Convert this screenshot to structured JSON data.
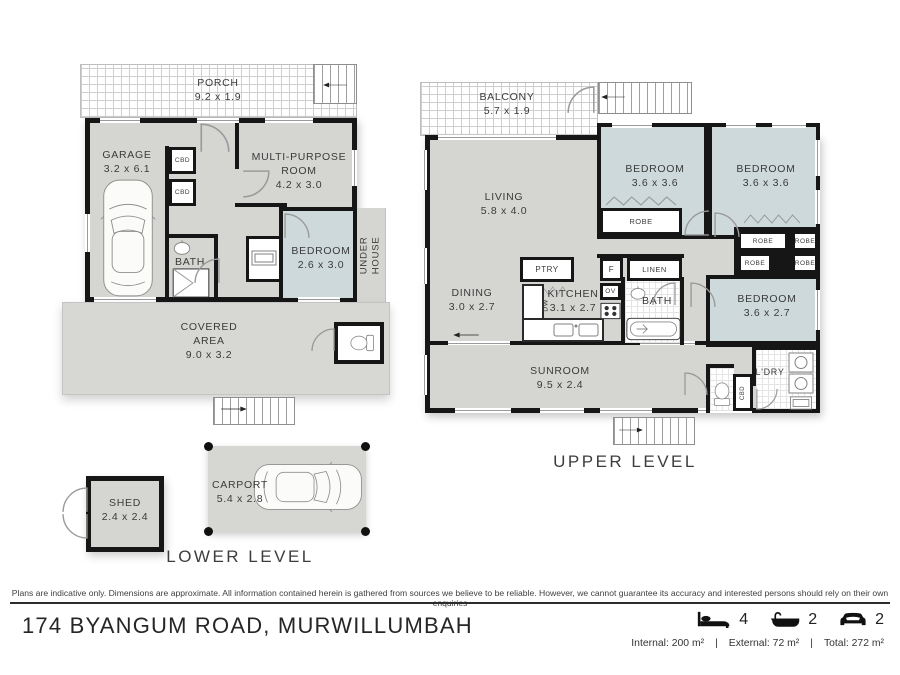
{
  "colors": {
    "wall": "#161616",
    "floor": "#d5d5d2",
    "bedroom_fill": "#cdd9da",
    "carport_fill": "#d6d6d3"
  },
  "levels": {
    "lower": "LOWER LEVEL",
    "upper": "UPPER LEVEL"
  },
  "lower": {
    "porch": {
      "name": "PORCH",
      "dim": "9.2 x 1.9"
    },
    "garage": {
      "name": "GARAGE",
      "dim": "3.2 x 6.1"
    },
    "multi_purpose": {
      "name": "MULTI-PURPOSE\nROOM",
      "dim": "4.2 x 3.0"
    },
    "bedroom": {
      "name": "BEDROOM",
      "dim": "2.6 x 3.0"
    },
    "bath": "BATH",
    "cbd": "CBD",
    "under_house": "UNDER\nHOUSE",
    "covered": {
      "name": "COVERED\nAREA",
      "dim": "9.0 x 3.2"
    },
    "shed": {
      "name": "SHED",
      "dim": "2.4 x 2.4"
    },
    "carport": {
      "name": "CARPORT",
      "dim": "5.4 x 2.8"
    }
  },
  "upper": {
    "balcony": {
      "name": "BALCONY",
      "dim": "5.7 x 1.9"
    },
    "living": {
      "name": "LIVING",
      "dim": "5.8 x 4.0"
    },
    "dining": {
      "name": "DINING",
      "dim": "3.0 x 2.7"
    },
    "kitchen": {
      "name": "KITCHEN",
      "dim": "3.1 x 2.7"
    },
    "sunroom": {
      "name": "SUNROOM",
      "dim": "9.5 x 2.4"
    },
    "bedroom1": {
      "name": "BEDROOM",
      "dim": "3.6 x 3.6"
    },
    "bedroom2": {
      "name": "BEDROOM",
      "dim": "3.6 x 3.6"
    },
    "bedroom3": {
      "name": "BEDROOM",
      "dim": "3.6 x 2.7"
    },
    "bath": "BATH",
    "linen": "LINEN",
    "ptry": "PTRY",
    "ldry": "L'DRY",
    "robe": "ROBE",
    "fridge": "F",
    "oven": "OV",
    "dw": "DW",
    "cbd": "CBD"
  },
  "footer": {
    "disclaimer": "Plans are indicative only. Dimensions are approximate. All information contained herein is gathered from sources we believe to be reliable. However, we cannot guarantee its accuracy and interested persons should rely on their own enquiries",
    "address": "174 BYANGUM ROAD, MURWILLUMBAH",
    "stats": {
      "beds": "4",
      "baths": "2",
      "cars": "2"
    },
    "areas": {
      "internal": "Internal: 200 m²",
      "external": "External: 72 m²",
      "total": "Total: 272 m²",
      "sep": "|"
    }
  }
}
